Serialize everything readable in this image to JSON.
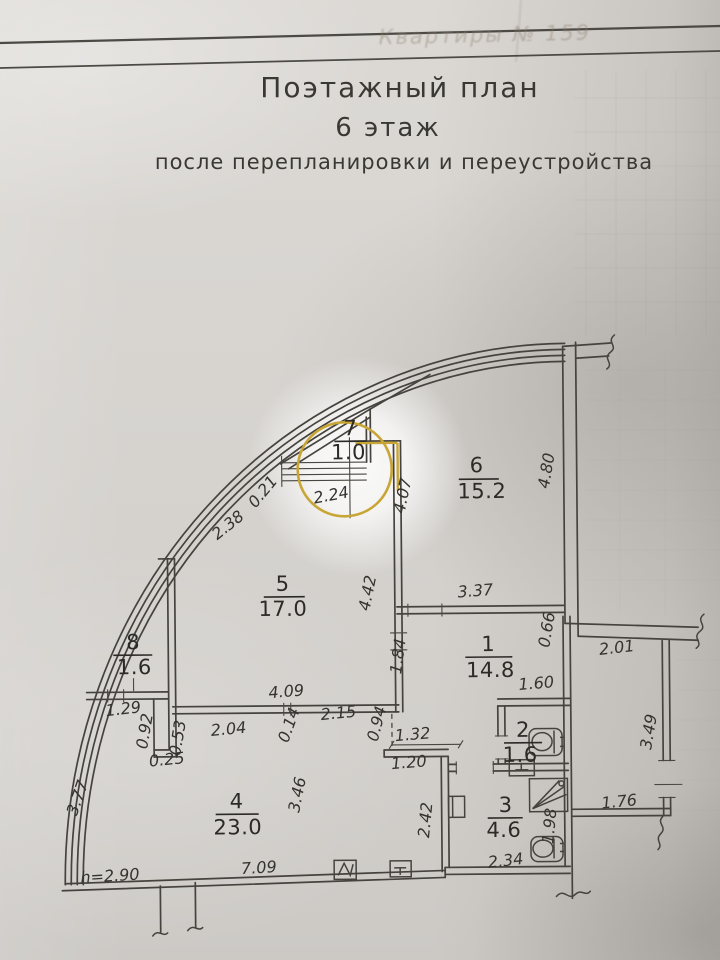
{
  "header": {
    "ghost_text": "Квартиры № 159",
    "title_line1": "Поэтажный план",
    "title_line2": "6 этаж",
    "title_line3": "после перепланировки и переустройства"
  },
  "rooms": {
    "r1": {
      "number": "1",
      "area": "14.8"
    },
    "r2": {
      "number": "2",
      "area": "1.6"
    },
    "r3": {
      "number": "3",
      "area": "4.6"
    },
    "r4": {
      "number": "4",
      "area": "23.0"
    },
    "r5": {
      "number": "5",
      "area": "17.0"
    },
    "r6": {
      "number": "6",
      "area": "15.2"
    },
    "r7": {
      "number": "7",
      "area": "1.0"
    },
    "r8": {
      "number": "8",
      "area": "1.6"
    }
  },
  "dimensions": {
    "d238": "2.38",
    "d021": "0.21",
    "d224": "2.24",
    "d407": "4.07",
    "d480": "4.80",
    "d337": "3.37",
    "d066": "0.66",
    "d201": "2.01",
    "d442": "4.42",
    "d184": "1.84",
    "d409": "4.09",
    "d014": "0.14",
    "d215": "2.15",
    "d094": "0.94",
    "d129": "1.29",
    "d092": "0.92",
    "d053": "0.53",
    "d025": "0.25",
    "d204": "2.04",
    "d160": "1.60",
    "d349": "3.49",
    "d132": "1.32",
    "d120": "1.20",
    "d242": "2.42",
    "d198": "1.98",
    "d176": "1.76",
    "d234": "2.34",
    "d346": "3.46",
    "d377": "3.77",
    "d709": "7.09",
    "h290": "h=2.90"
  },
  "colors": {
    "plan_line": "#46433e",
    "annotation_highlight": "#c8a636"
  }
}
